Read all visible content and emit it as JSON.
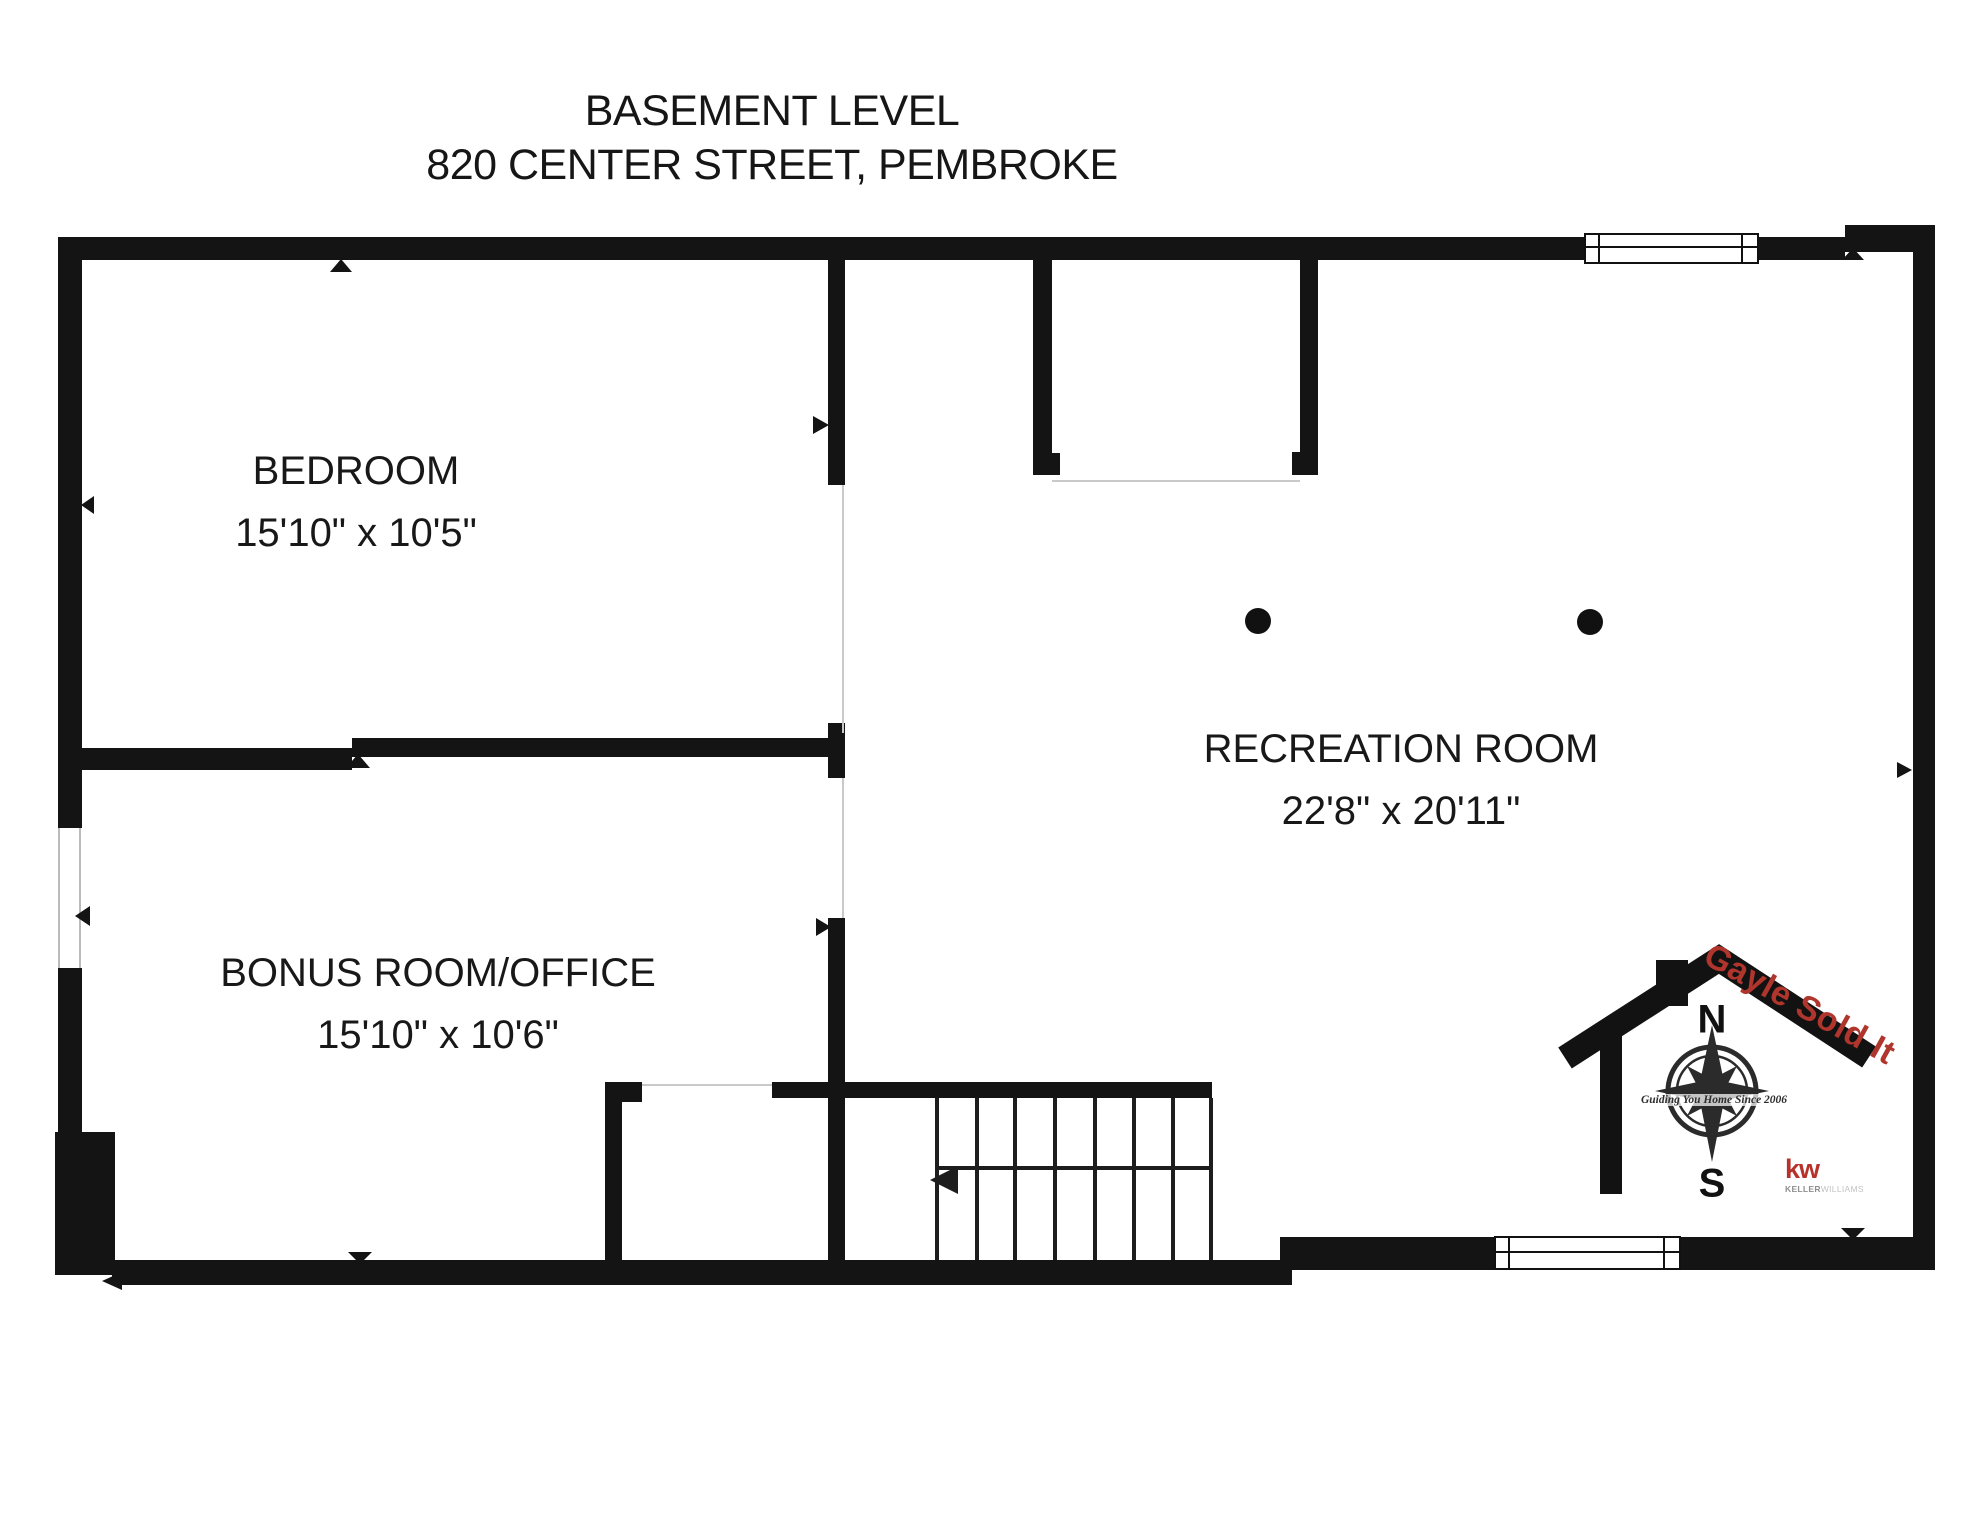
{
  "title": {
    "line1": "BASEMENT LEVEL",
    "line2": "820 CENTER STREET, PEMBROKE"
  },
  "rooms": {
    "bedroom": {
      "name": "BEDROOM",
      "dims": "15'10\" x 10'5\""
    },
    "bonus": {
      "name": "BONUS ROOM/OFFICE",
      "dims": "15'10\" x 10'6\""
    },
    "recreation": {
      "name": "RECREATION ROOM",
      "dims": "22'8\" x 20'11\""
    }
  },
  "logo": {
    "banner": "Gayle Sold It",
    "north": "N",
    "south": "S",
    "motto": "Guiding You Home Since 2006",
    "brand": "kw",
    "brand_sub_1": "KELLER",
    "brand_sub_2": "WILLIAMS",
    "banner_color": "#b0352c",
    "brand_color": "#b8322c"
  },
  "colors": {
    "wall": "#141414",
    "background": "#ffffff",
    "faint_line": "#c9c9c9"
  }
}
